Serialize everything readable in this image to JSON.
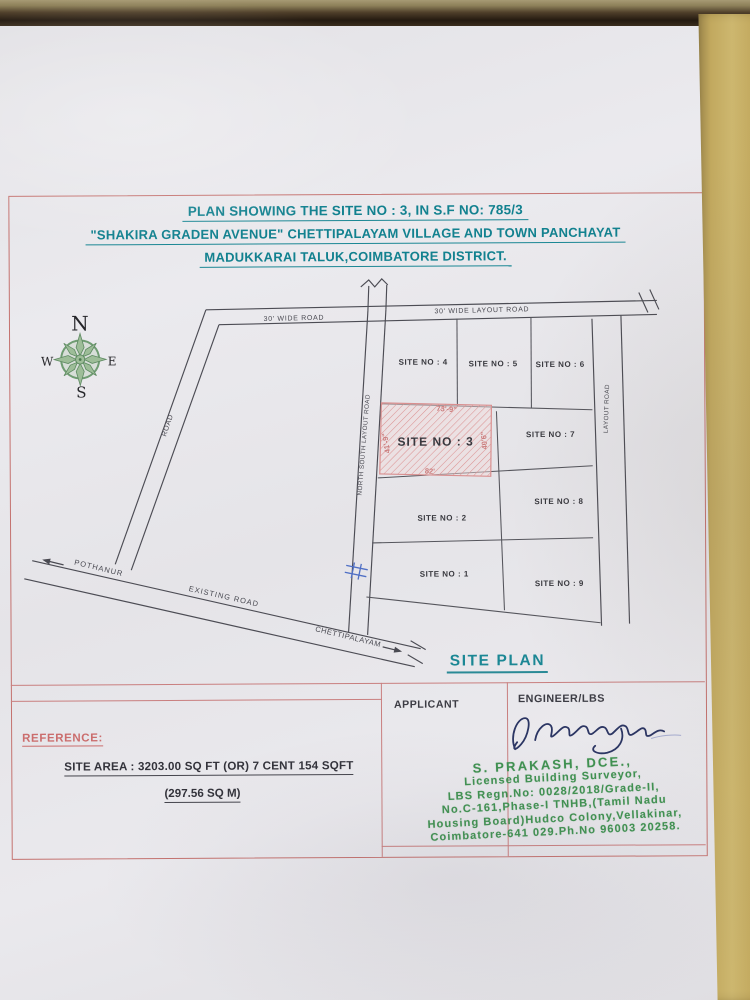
{
  "document": {
    "title_lines": [
      "PLAN SHOWING THE SITE NO : 3, IN S.F NO: 785/3",
      "\"SHAKIRA GRADEN AVENUE\" CHETTIPALAYAM  VILLAGE AND TOWN PANCHAYAT",
      "MADUKKARAI TALUK,COIMBATORE DISTRICT."
    ],
    "caption": "SITE PLAN"
  },
  "compass": {
    "n": "N",
    "s": "S",
    "e": "E",
    "w": "W"
  },
  "plan": {
    "roads": {
      "top_left": "30' WIDE ROAD",
      "top_right": "30' WIDE LAYOUT ROAD",
      "west": "ROAD",
      "north_south": "NORTH SOUTH LAYOUT ROAD",
      "east": "LAYOUT ROAD",
      "existing": "EXISTING ROAD",
      "toward_west": "POTHANUR",
      "toward_east": "CHETTIPALAYAM"
    },
    "sites": [
      "SITE NO : 1",
      "SITE NO : 2",
      "SITE NO : 3",
      "SITE NO : 4",
      "SITE NO : 5",
      "SITE NO : 6",
      "SITE NO : 7",
      "SITE NO : 8",
      "SITE NO : 9"
    ],
    "site3_dims": {
      "top": "73'-9\"",
      "left": "41'-9\"",
      "right": "40'6\"",
      "bottom": "82'"
    }
  },
  "reference": {
    "heading": "REFERENCE:",
    "area_line1": "SITE AREA : 3203.00 SQ FT (OR) 7 CENT 154 SQFT",
    "area_line2": "(297.56 SQ M)"
  },
  "parties": {
    "applicant_label": "APPLICANT",
    "engineer_label": "ENGINEER/LBS",
    "stamp_lines": [
      "S. PRAKASH, DCE.,",
      "Licensed Building Surveyor,",
      "LBS Regn.No: 0028/2018/Grade-II,",
      "No.C-161,Phase-I TNHB,(Tamil Nadu",
      "Housing Board)Hudco Colony,Vellakinar,",
      "Coimbatore-641 029.Ph.No 96003 20258."
    ]
  },
  "colors": {
    "frame_red": "#c4726f",
    "title_teal": "#12818f",
    "stamp_green": "#3f9150",
    "hatch_pink": "#dc9494",
    "ink_blue": "#2b3563",
    "plan_line": "#4c4c54"
  }
}
